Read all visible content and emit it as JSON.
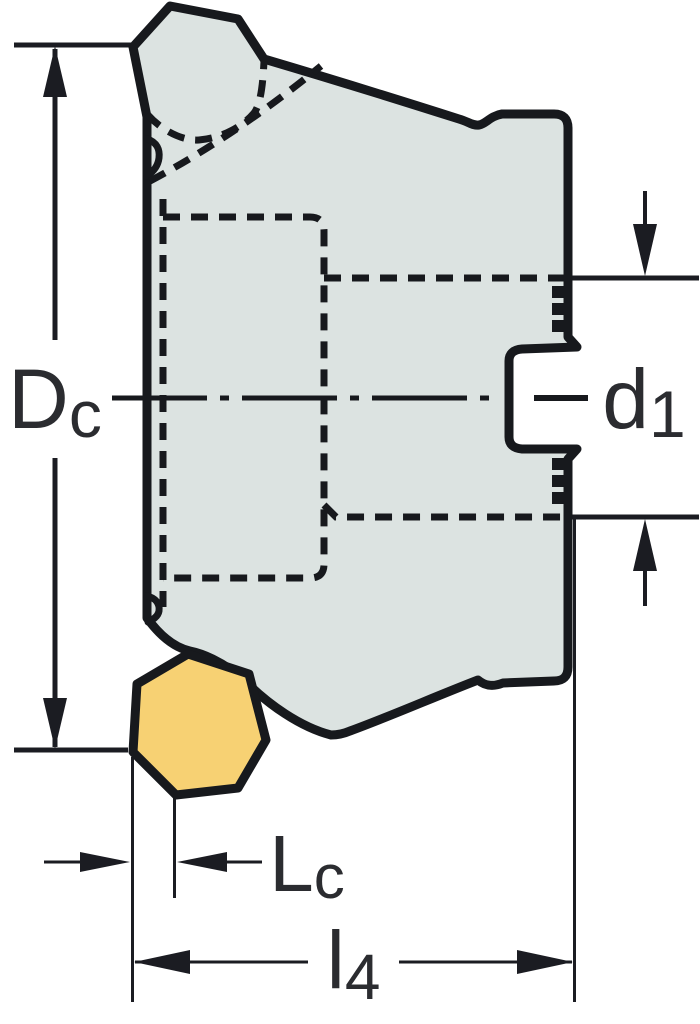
{
  "diagram": {
    "description": "Side-view technical drawing of a face milling cutter body with one yellow heptagonal indexable insert and dimension callouts",
    "labels": {
      "dc": {
        "main": "D",
        "sub": "c"
      },
      "d1": {
        "main": "d",
        "sub": "1"
      },
      "lc": {
        "main": "L",
        "sub": "c"
      },
      "l4": {
        "main": "l",
        "sub": "4"
      }
    },
    "colors": {
      "bg": "#ffffff",
      "body_fill": "#dce3e1",
      "insert_fill": "#f7d173",
      "outline": "#17191d",
      "line": "#1b1c22",
      "text": "#2b2c30",
      "box": "#ffffff"
    }
  }
}
